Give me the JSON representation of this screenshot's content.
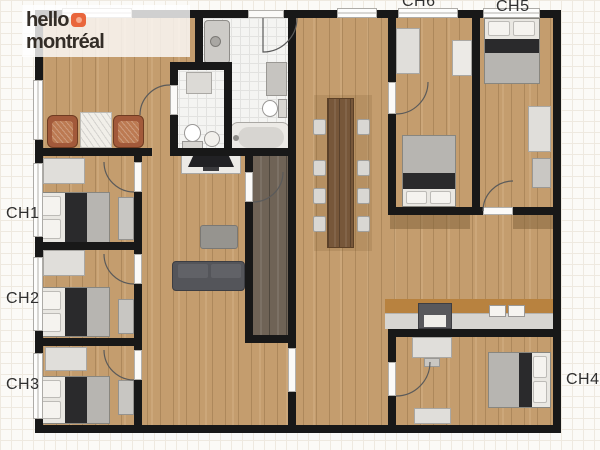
{
  "logo": {
    "word1": "hello",
    "word2": "montréal",
    "icon": "orange-speech-square"
  },
  "room_labels": {
    "ch1": "CH1",
    "ch2": "CH2",
    "ch3": "CH3",
    "ch4": "CH4",
    "ch5": "CH5",
    "ch6": "CH6"
  },
  "colors": {
    "wall": "#181818",
    "wood_floor": "#c49d6e",
    "corridor_dark_wood": "#6f6356",
    "bathroom_tile": "#f4f4f2",
    "logo_accent_orange": "#e9663c",
    "logo_text": "#332d27",
    "bed_blanket_dark": "#2a2a2c",
    "kitchen_backsplash_tan": "#b8823f",
    "grid_background": "#fbfaf7"
  }
}
